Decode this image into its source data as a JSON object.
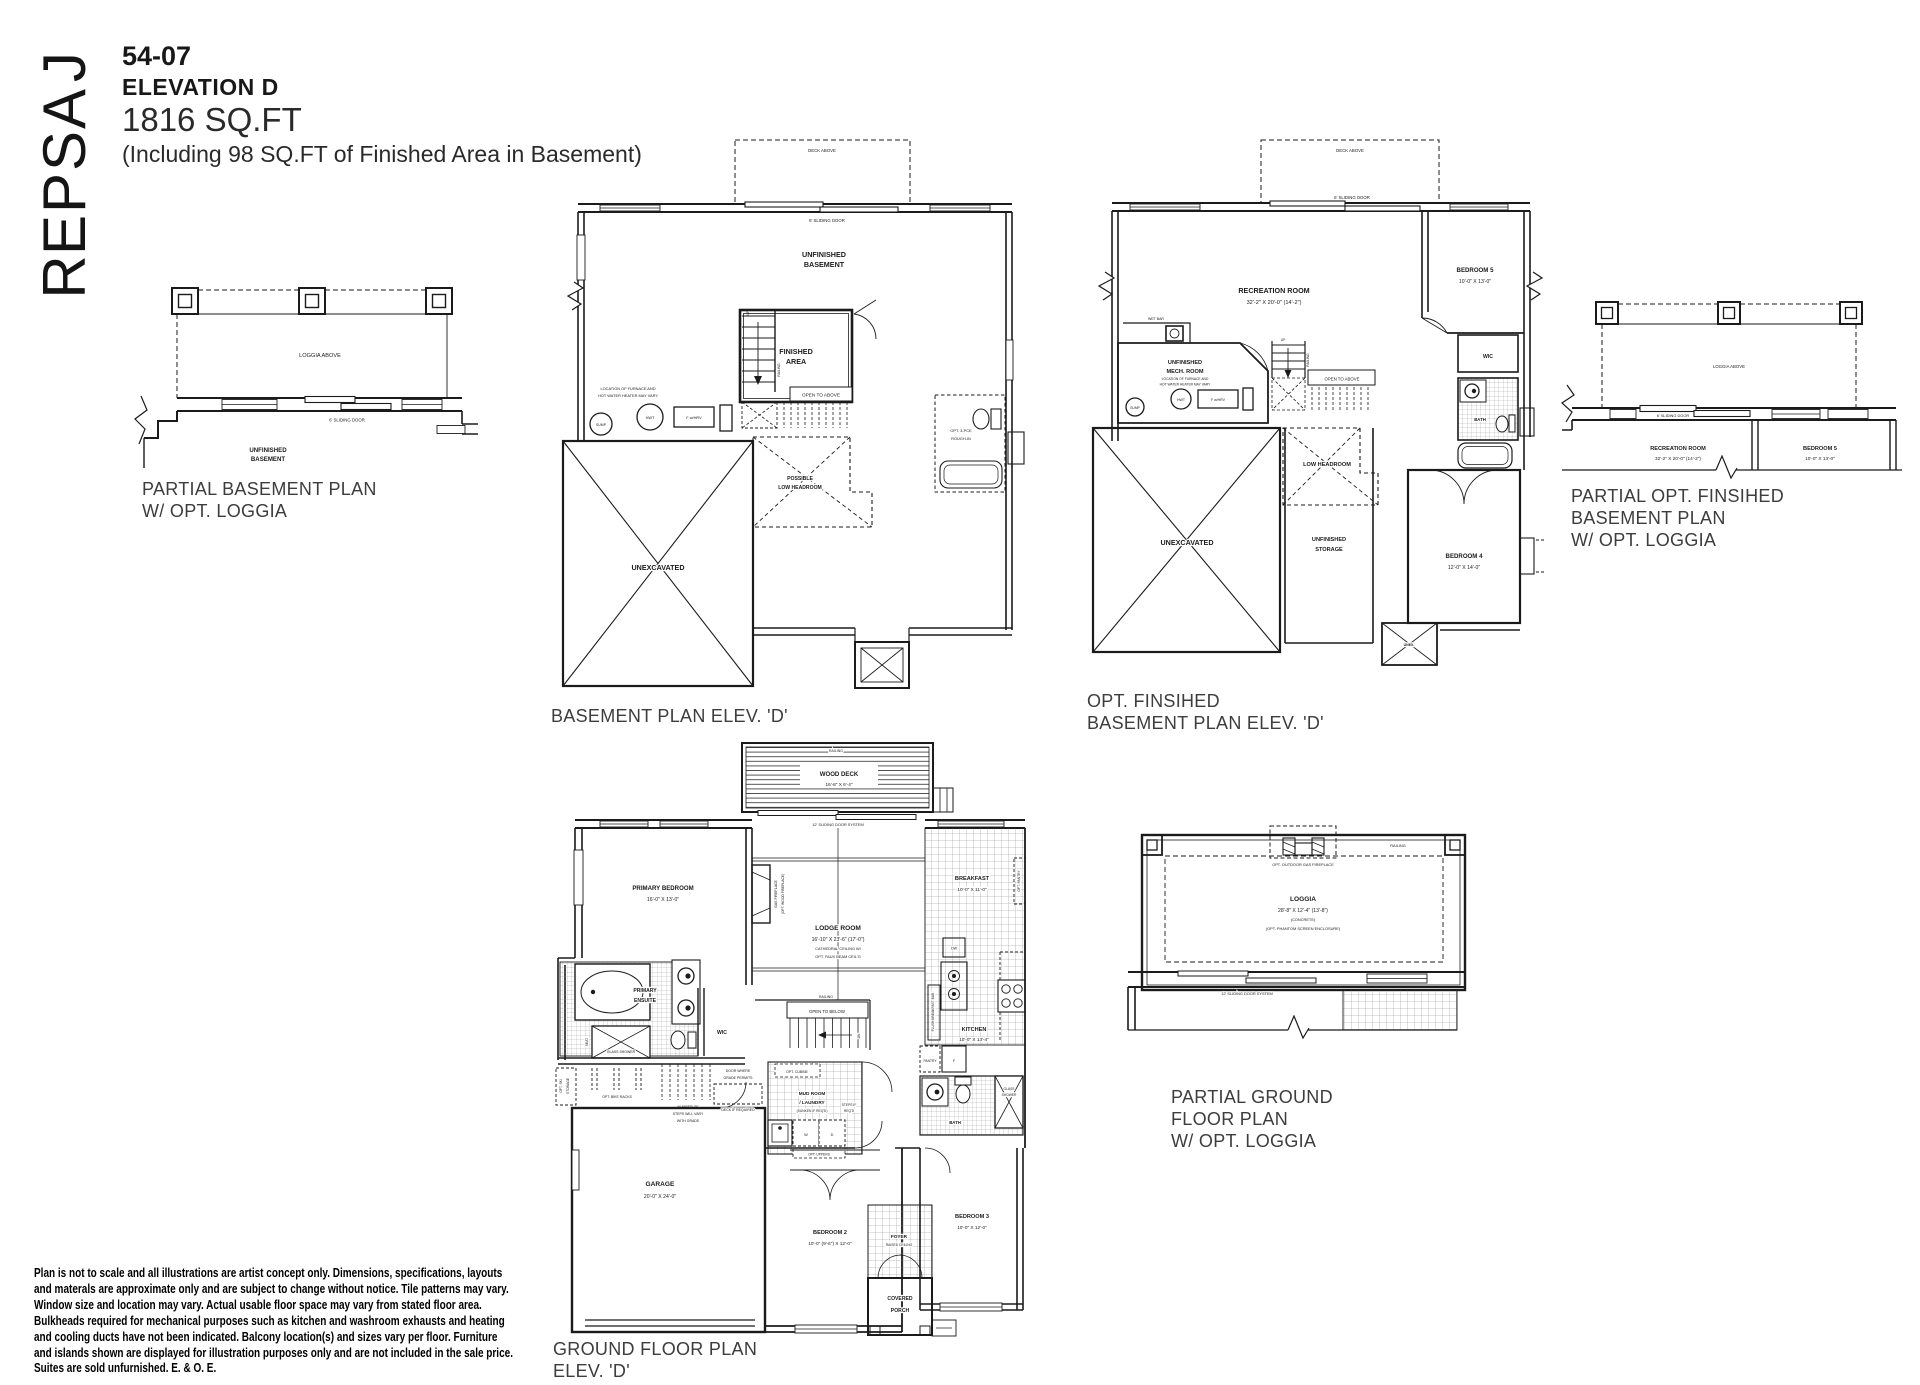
{
  "sheet": {
    "model_name": "JASPER",
    "plan_number": "54-07",
    "elevation": "ELEVATION D",
    "area": "1816 SQ.FT",
    "area_note": "(Including 98 SQ.FT of Finished Area in Basement)"
  },
  "p1": {
    "loggia_above": "LOGGIA ABOVE",
    "sliding_door": "6' SLIDING DOOR",
    "unfinished_1": "UNFINISHED",
    "unfinished_2": "BASEMENT",
    "caption_1": "PARTIAL BASEMENT PLAN",
    "caption_2": "W/ OPT. LOGGIA"
  },
  "p2": {
    "deck_above": "DECK ABOVE",
    "sliding_door": "6' SLIDING DOOR",
    "unfinished_1": "UNFINISHED",
    "unfinished_2": "BASEMENT",
    "furnace_1": "LOCATION OF FURNACE AND",
    "furnace_2": "HOT WATER HEATER MAY VARY",
    "sump": "SUMP",
    "hwt": "HWT",
    "fhrv": "F w/HRV",
    "finished_1": "FINISHED",
    "finished_2": "AREA",
    "up": "UP",
    "railing": "RAILING",
    "open_above": "OPEN TO ABOVE",
    "plh_1": "POSSIBLE",
    "plh_2": "LOW HEADROOM",
    "unexcavated": "UNEXCAVATED",
    "rough_1": "OPT. 3-PCE",
    "rough_2": "ROUGH-IN",
    "caption": "BASEMENT PLAN ELEV. 'D'"
  },
  "p3": {
    "deck_above": "DECK ABOVE",
    "sliding_door": "6' SLIDING DOOR",
    "rec_room": "RECREATION ROOM",
    "rec_dim": "32'-2\" X 20'-0\" (14'-2\")",
    "bed5": "BEDROOM 5",
    "bed5_dim": "10'-0\" X 13'-0\"",
    "wet_bar": "WET BAR",
    "mech_1": "UNFINISHED",
    "mech_2": "MECH. ROOM",
    "furnace_1": "LOCATION OF FURNACE AND",
    "furnace_2": "HOT WATER HEATER MAY VARY",
    "sump": "SUMP",
    "hwt": "HWT",
    "fhrv": "F w/HRV",
    "up": "UP",
    "railing": "RAILING",
    "open_above": "OPEN TO ABOVE",
    "wic": "WIC",
    "bath": "BATH",
    "low_headroom": "LOW HEADROOM",
    "unexcavated": "UNEXCAVATED",
    "storage_1": "UNFINISHED",
    "storage_2": "STORAGE",
    "bed4": "BEDROOM 4",
    "bed4_dim": "12'-0\" X 14'-0\"",
    "unex": "UNEX.",
    "caption_1": "OPT. FINSIHED",
    "caption_2": "BASEMENT PLAN ELEV. 'D'"
  },
  "p4": {
    "loggia_above": "LOGGIA ABOVE",
    "sliding_door": "6' SLIDING DOOR",
    "rec_room": "RECREATION ROOM",
    "rec_dim": "32'-2\" X 20'-0\" (14'-2\")",
    "bed5": "BEDROOM 5",
    "bed5_dim": "10'-0\" X 13'-0\"",
    "caption_1": "PARTIAL OPT. FINSIHED",
    "caption_2": "BASEMENT PLAN",
    "caption_3": "W/ OPT. LOGGIA"
  },
  "p5": {
    "railing_deck": "RAILING",
    "wood_deck": "WOOD DECK",
    "wood_deck_dim": "16'-8\" X 6'-4\"",
    "slider12": "12' SLIDING DOOR SYSTEM",
    "primary": "PRIMARY BEDROOM",
    "primary_dim": "16'-0\" X 13'-0\"",
    "fp_1": "GAS FIREPLACE",
    "fp_2": "(OPT. WOOD FIREPLACE)",
    "lodge": "LODGE ROOM",
    "lodge_dim": "16'-10\" X 23'-6\" (17'-0\")",
    "lodge_n1": "CATHEDRAL CEILING W/",
    "lodge_n2": "OPT. FAUX BEAM CEIL'G",
    "breakfast": "BREAKFAST",
    "breakfast_dim": "10'-0\" X 11'-0\"",
    "opt_pantry": "OPT. PANTRY",
    "flush_bar": "FLUSH BREAKFAST BAR",
    "dw": "DW",
    "railing_stair": "RAILING",
    "open_below": "OPEN TO BELOW",
    "dn": "DN",
    "kitchen": "KITCHEN",
    "kitchen_dim": "10'-0\" X 13'-4\"",
    "pantry": "PANTRY",
    "fridge": "F",
    "ensuite_1": "PRIMARY",
    "ensuite_2": "ENSUITE",
    "seat": "SEAT",
    "glass_shower": "GLASS SHOWER",
    "wic": "WIC",
    "ski_1": "OPT. SKI",
    "ski_2": "STORAGE",
    "bike": "OPT. BIKE RACKS",
    "steps_1": "NUMBER OF",
    "steps_2": "STEPS WILL VARY",
    "steps_3": "WITH GRADE",
    "door_1": "DOOR WHERE",
    "door_2": "GRADE PERMITS",
    "deck_req": "DECK IF REQUIRED",
    "cubbie": "OPT. CUBBIE",
    "mud_1": "MUD ROOM",
    "mud_2": "/ LAUNDRY",
    "mud_3": "(SUNKEN IF REQ'D)",
    "steps_req_1": "STEPS IF",
    "steps_req_2": "REQ'D",
    "w": "W",
    "d": "D",
    "uppers": "OPT. UPPERS",
    "garage": "GARAGE",
    "garage_dim": "20'-0\" X 24'-0\"",
    "bed2": "BEDROOM 2",
    "bed2_dim": "10'-0\" (9'-6\") X 12'-0\"",
    "foyer": "FOYER",
    "foyer_note": "RAISED CEILING",
    "bed3": "BEDROOM 3",
    "bed3_dim": "10'-0\" X 12'-0\"",
    "bath": "BATH",
    "gs2_1": "GLASS",
    "gs2_2": "SHOWER",
    "porch_1": "COVERED",
    "porch_2": "PORCH",
    "caption_1": "GROUND FLOOR PLAN",
    "caption_2": "ELEV. 'D'"
  },
  "p6": {
    "railing": "RAILING",
    "fireplace": "OPT. OUTDOOR GAS FIREPLACE",
    "loggia": "LOGGIA",
    "loggia_dim": "28'-8\" X 12'-4\" (13'-8\")",
    "concrete": "(CONCRETE)",
    "screen": "(OPT. PHANTOM SCREEN ENCLOSURE)",
    "slider12": "12' SLIDING DOOR SYSTEM",
    "caption_1": "PARTIAL GROUND",
    "caption_2": "FLOOR PLAN",
    "caption_3": "W/ OPT. LOGGIA"
  },
  "disclaimer": {
    "lines": [
      "Plan is not to scale and all illustrations are artist concept only. Dimensions, specifications, layouts",
      "and materals are approximate only and are subject to change without notice. Tile patterns may vary.",
      "Window size and location may vary. Actual usable floor space may vary from stated floor area.",
      "Bulkheads required for mechanical purposes such as kitchen and washroom exhausts and heating",
      "and cooling ducts have not been indicated. Balcony location(s) and sizes vary per floor. Furniture",
      "and islands shown are displayed for illustration purposes only and are not included in the sale price.",
      "Suites are sold unfurnished. E. & O. E."
    ]
  }
}
